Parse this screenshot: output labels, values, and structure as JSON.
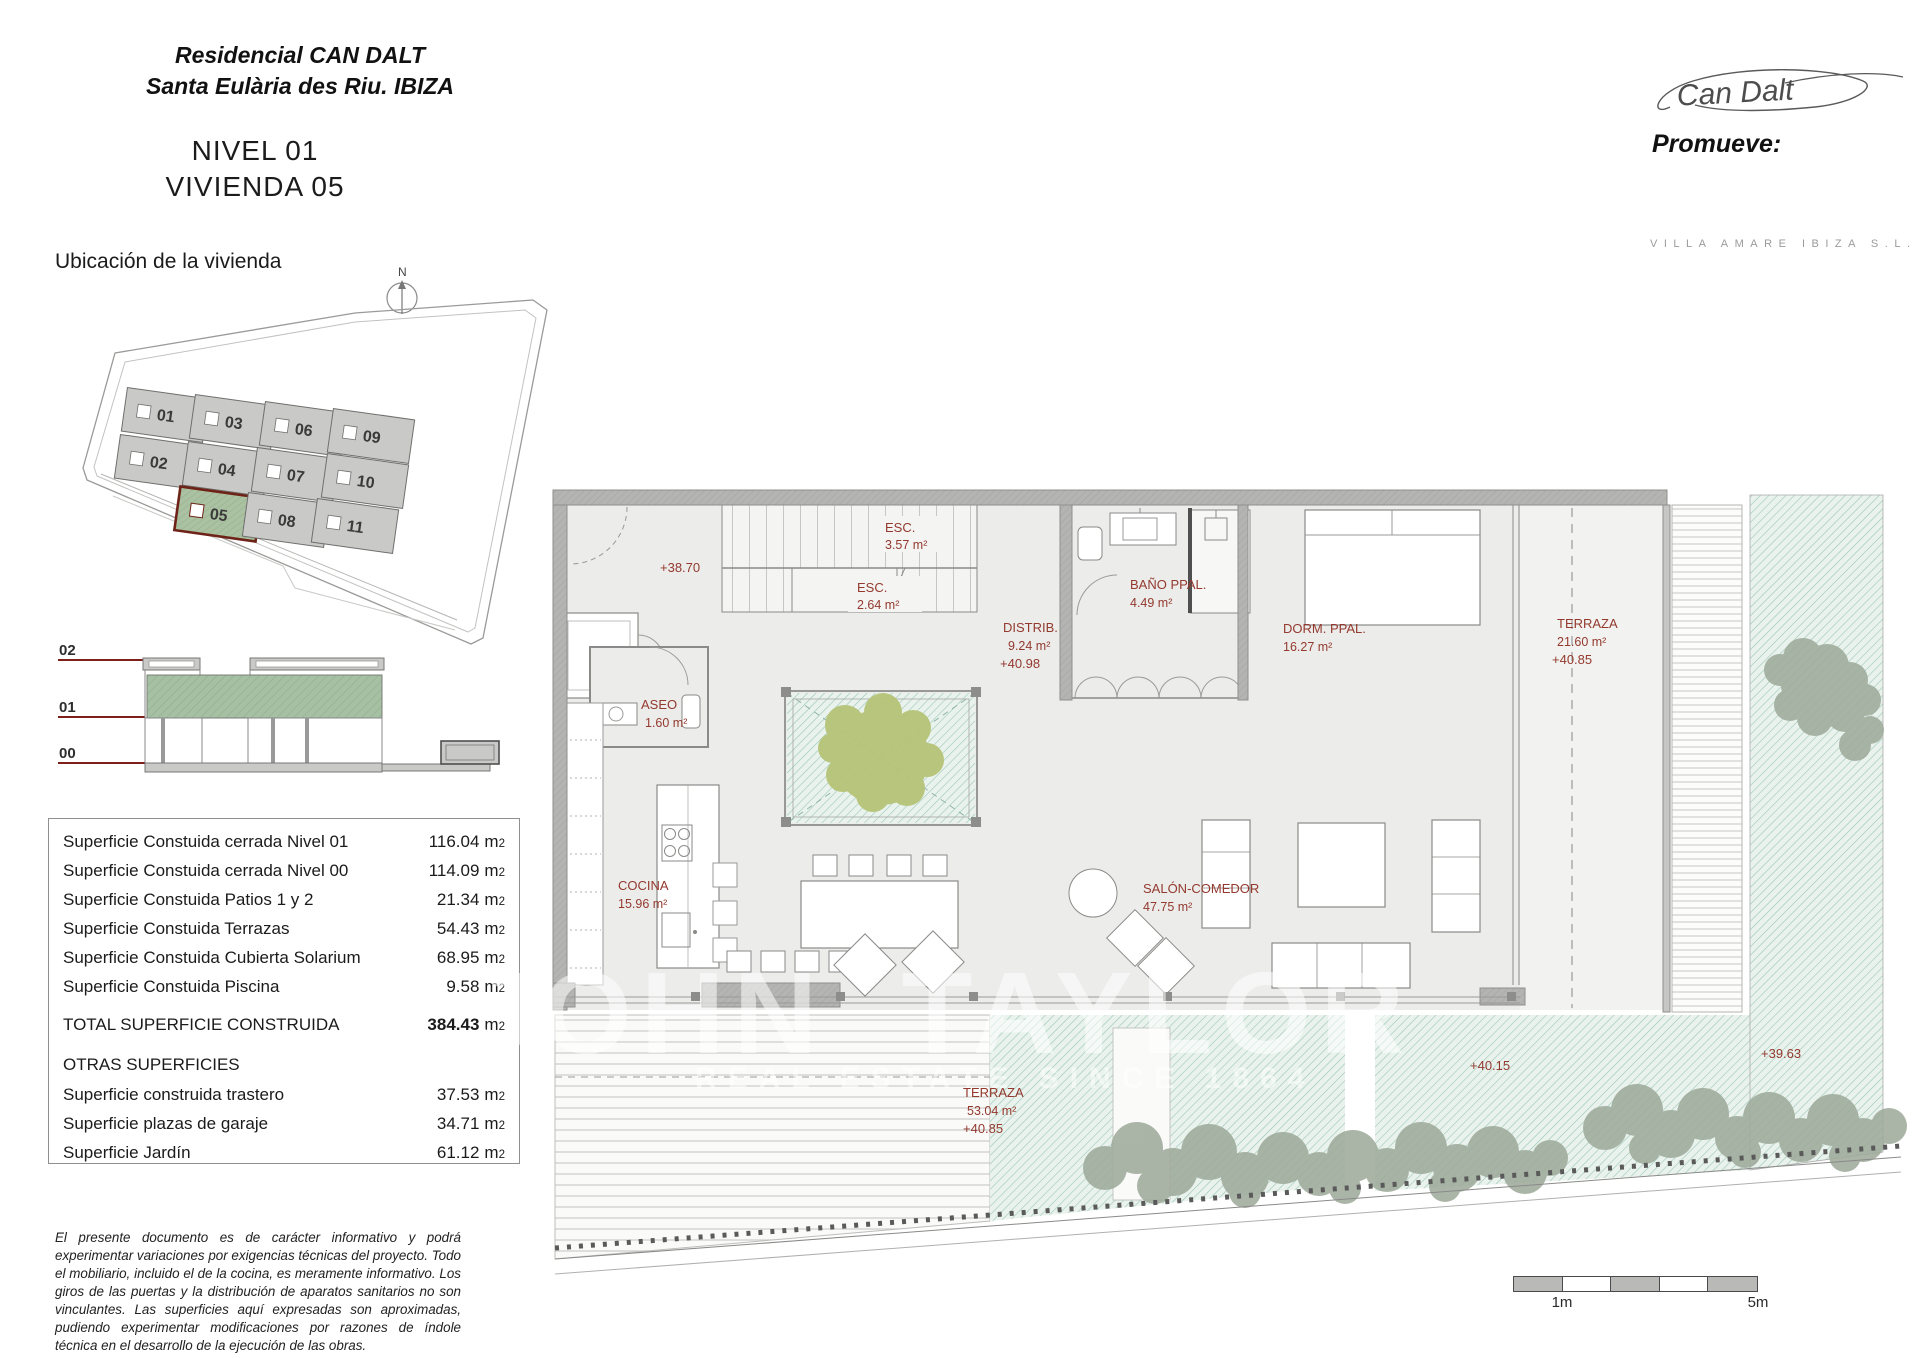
{
  "header": {
    "project_line1": "Residencial CAN DALT",
    "project_line2": "Santa Eulària des Riu. IBIZA",
    "sheet_line1": "NIVEL 01",
    "sheet_line2": "VIVIENDA 05",
    "signature": "Can Dalt",
    "promoter_label": "Promueve:",
    "promoter_name": "VILLA AMARE IBIZA S.L."
  },
  "location_plan": {
    "title": "Ubicación de la vivienda",
    "north": "N",
    "highlighted_unit": "05",
    "units": [
      "01",
      "03",
      "06",
      "09",
      "02",
      "04",
      "07",
      "10",
      "05",
      "08",
      "11"
    ]
  },
  "section_diagram": {
    "levels": [
      "02",
      "01",
      "00"
    ]
  },
  "areas_table": {
    "unit_m": "m",
    "unit_exp": "2",
    "rows": [
      {
        "label": "Superficie Constuida cerrada Nivel 01",
        "value": "116.04"
      },
      {
        "label": "Superficie Constuida cerrada Nivel 00",
        "value": "114.09"
      },
      {
        "label": "Superficie Constuida Patios 1 y 2",
        "value": "21.34"
      },
      {
        "label": "Superficie Constuida Terrazas",
        "value": "54.43"
      },
      {
        "label": "Superficie Constuida Cubierta Solarium",
        "value": "68.95"
      },
      {
        "label": "Superficie Constuida Piscina",
        "value": "9.58"
      }
    ],
    "total_label": "TOTAL SUPERFICIE CONSTRUIDA",
    "total_value": "384.43",
    "other_header": "OTRAS SUPERFICIES",
    "other_rows": [
      {
        "label": "Superficie construida trastero",
        "value": "37.53"
      },
      {
        "label": "Superficie plazas de garaje",
        "value": "34.71"
      },
      {
        "label": "Superficie Jardín",
        "value": "61.12"
      }
    ]
  },
  "disclaimer": "El presente documento es de carácter informativo y podrá experimentar variaciones por exigencias técnicas del proyecto. Todo el mobiliario, incluido el de la cocina, es meramente informativo. Los giros de las puertas y la distribución de aparatos sanitarios no son vinculantes. Las superficies aquí expresadas son aproximadas, pudiendo experimentar modificaciones por razones de índole técnica en el desarrollo de la ejecución de las obras.",
  "floor_plan": {
    "labels": {
      "esc1_name": "ESC.",
      "esc1_area": "3.57 m²",
      "esc2_name": "ESC.",
      "esc2_area": "2.64 m²",
      "level_3870": "+38.70",
      "distrib_name": "DISTRIB.",
      "distrib_area": "9.24 m²",
      "distrib_level": "+40.98",
      "aseo_name": "ASEO",
      "aseo_area": "1.60 m²",
      "banyo_name": "BAÑO PPAL.",
      "banyo_area": "4.49 m²",
      "dorm_name": "DORM. PPAL.",
      "dorm_area": "16.27 m²",
      "terraza1_name": "TERRAZA",
      "terraza1_area": "21.60 m²",
      "terraza1_level": "+40.85",
      "cocina_name": "COCINA",
      "cocina_area": "15.96 m²",
      "salon_name": "SALÓN-COMEDOR",
      "salon_area": "47.75 m²",
      "terraza2_name": "TERRAZA",
      "terraza2_area": "53.04 m²",
      "terraza2_level": "+40.85",
      "level_4015": "+40.15",
      "level_3963": "+39.63"
    },
    "watermark_line1": "JOHN TAYLOR",
    "watermark_line2": "REAL ESTATE SINCE 1864"
  },
  "scale_bar": {
    "label_start": "1m",
    "label_end": "5m"
  },
  "colors": {
    "label_red": "#93392e",
    "level_line_red": "#7e1f1a",
    "highlight_green": "#a9c1a1",
    "highlight_border": "#6e2318",
    "teal_hatch": "#9cc7b6",
    "tree_green": "#b6c478",
    "wall_gray": "#b4b4b2"
  }
}
